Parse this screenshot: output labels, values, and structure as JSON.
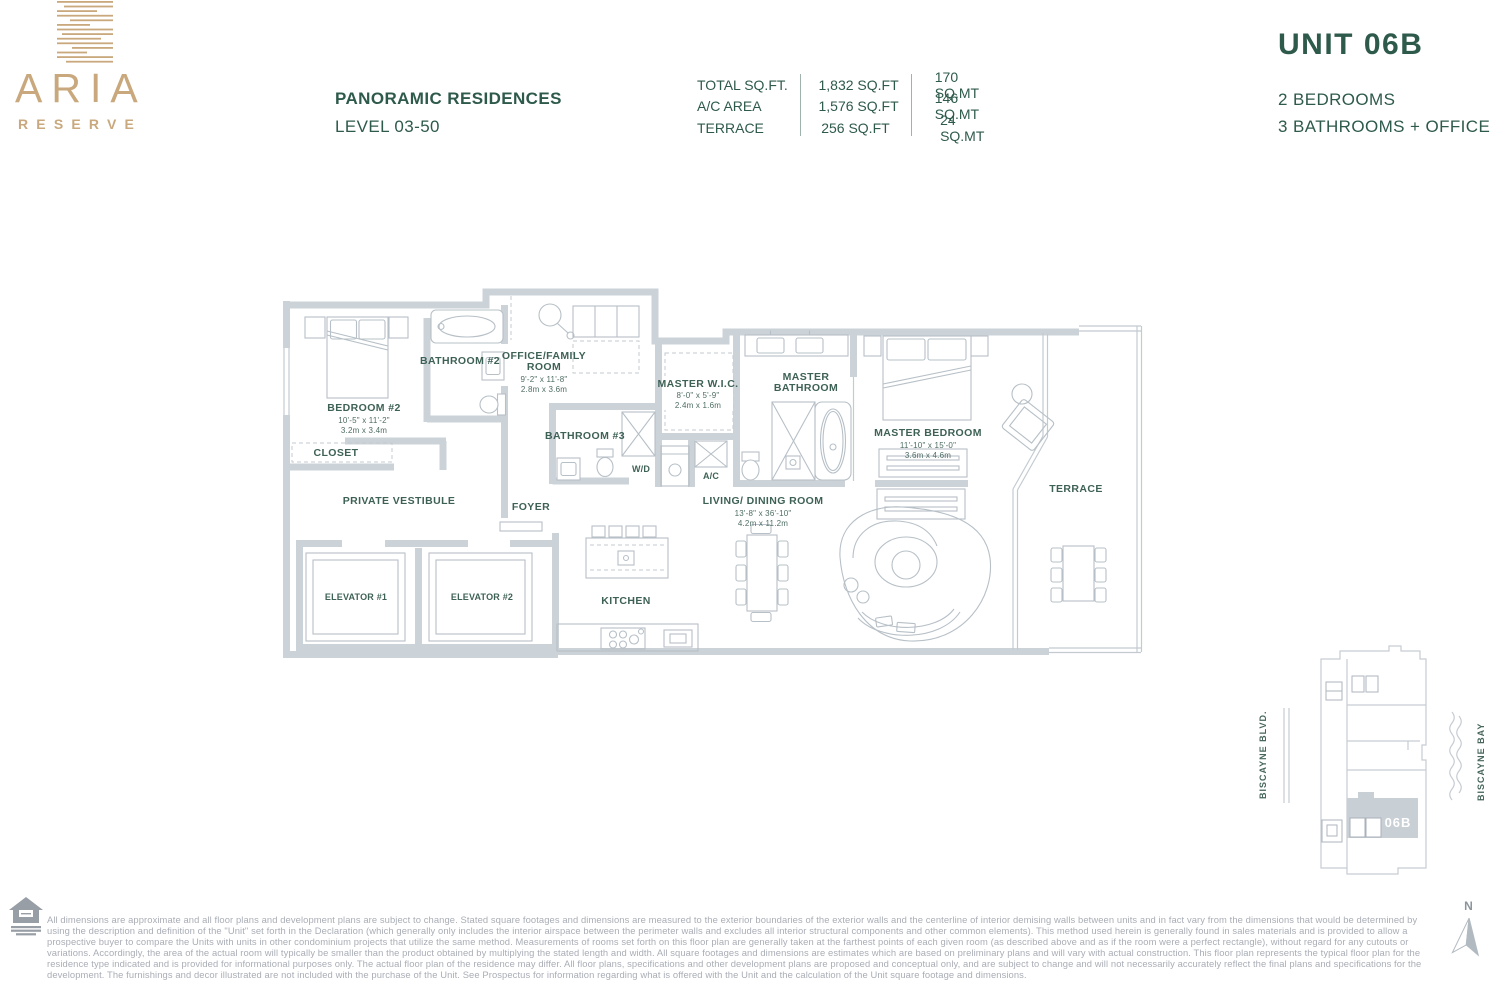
{
  "colors": {
    "brand_gold": "#C9A87D",
    "brand_green": "#2E5A4B",
    "label_green": "#3E6156",
    "wall_gray": "#CCD3D8",
    "line_gray": "#B7C0C7",
    "keymap_highlight": "#C8CFD5",
    "disclaimer_gray": "#A9ADB5"
  },
  "brand": {
    "logo_word": "ARIA",
    "logo_sub": "RESERVE"
  },
  "header": {
    "residence_type": "PANORAMIC RESIDENCES",
    "level": "LEVEL 03-50",
    "unit_title": "UNIT 06B",
    "bedrooms": "2 BEDROOMS",
    "bathrooms": "3 BATHROOMS + OFFICE",
    "area_rows": [
      {
        "label": "TOTAL SQ.FT.",
        "imperial": "1,832 SQ.FT",
        "metric": "170 SQ.MT"
      },
      {
        "label": "A/C AREA",
        "imperial": "1,576 SQ.FT",
        "metric": "146 SQ.MT"
      },
      {
        "label": "TERRACE",
        "imperial": "256 SQ.FT",
        "metric": "24 SQ.MT"
      }
    ]
  },
  "plan": {
    "bedroom2": {
      "name": "BEDROOM #2",
      "dims_ft": "10'-5\" x 11'-2\"",
      "dims_m": "3.2m x 3.4m"
    },
    "closet": {
      "name": "CLOSET"
    },
    "bathroom2": {
      "name": "BATHROOM #2"
    },
    "office": {
      "name_line1": "OFFICE/FAMILY",
      "name_line2": "ROOM",
      "dims_ft": "9'-2\" x 11'-8\"",
      "dims_m": "2.8m x 3.6m"
    },
    "bathroom3": {
      "name": "BATHROOM #3"
    },
    "wd": {
      "name": "W/D"
    },
    "ac": {
      "name": "A/C"
    },
    "master_wic": {
      "name": "MASTER W.I.C.",
      "dims_ft": "8'-0\" x 5'-9\"",
      "dims_m": "2.4m x 1.6m"
    },
    "master_bathroom": {
      "name_line1": "MASTER",
      "name_line2": "BATHROOM"
    },
    "master_bedroom": {
      "name": "MASTER BEDROOM",
      "dims_ft": "11'-10\" x 15'-0\"",
      "dims_m": "3.6m x 4.6m"
    },
    "living_dining": {
      "name": "LIVING/ DINING ROOM",
      "dims_ft": "13'-8\" x 36'-10\"",
      "dims_m": "4.2m x 11.2m"
    },
    "terrace": {
      "name": "TERRACE"
    },
    "private_vestibule": {
      "name": "PRIVATE VESTIBULE"
    },
    "foyer": {
      "name": "FOYER"
    },
    "kitchen": {
      "name": "KITCHEN"
    },
    "elevator1": {
      "name": "ELEVATOR #1"
    },
    "elevator2": {
      "name": "ELEVATOR #2"
    }
  },
  "keymap": {
    "street": "BISCAYNE BLVD.",
    "bay": "BISCAYNE BAY",
    "unit_label": "06B"
  },
  "compass": {
    "north_label": "N"
  },
  "footer": {
    "disclaimer": "All dimensions are approximate and all floor plans and development plans are subject to change. Stated square footages and dimensions are measured to the exterior boundaries of the exterior walls and the centerline of interior demising walls between units and in fact vary from the dimensions that would be determined by using the description and definition of the \"Unit\" set forth in the Declaration (which generally only includes the interior airspace between the perimeter walls and excludes all interior structural components and other common elements). This method used herein is generally found in sales materials and is provided to allow a prospective buyer to compare the Units with units in other condominium projects that utilize the same method. Measurements of rooms set forth on this floor plan are generally taken at the farthest points of each given room (as described above and as if the room were a perfect rectangle), without regard for any cutouts or variations. Accordingly, the area of the actual room will typically be smaller than the product obtained by multiplying the stated length and width. All square footages and dimensions are estimates which are based on preliminary plans and will vary with actual construction. This floor plan represents the typical floor plan for the residence type indicated and is provided for informational purposes only. The actual floor plan of the residence may differ. All floor plans, specifications and other development plans are proposed and conceptual only, and are subject to change and will not necessarily accurately reflect the final plans and specifications for the development. The furnishings and decor illustrated are not included with the purchase of the Unit. See Prospectus for information regarding what is offered with the Unit and the calculation of the Unit square footage and dimensions."
  }
}
